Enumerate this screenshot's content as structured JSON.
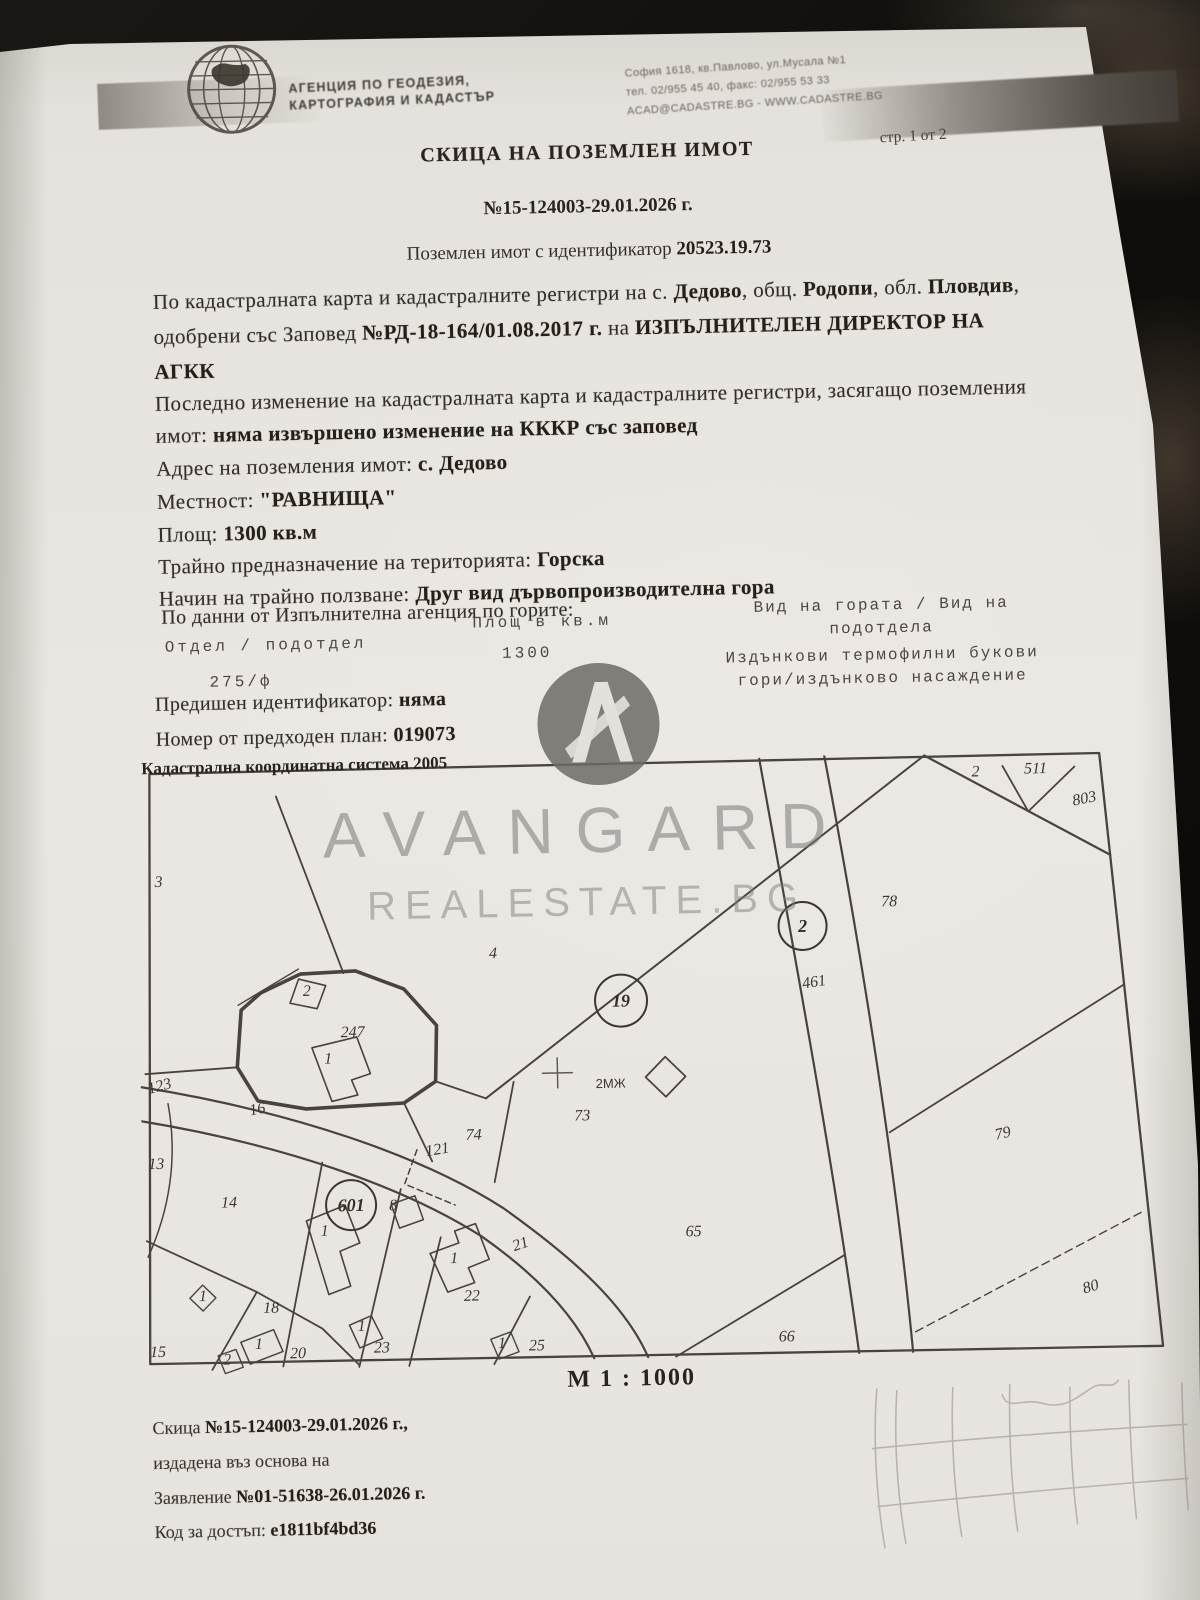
{
  "header": {
    "agency_line1": "АГЕНЦИЯ ПО ГЕОДЕЗИЯ,",
    "agency_line2": "КАРТОГРАФИЯ И КАДАСТЪР",
    "address_line1": "София 1618, кв.Павлово, ул.Мусала №1",
    "address_line2": "тел. 02/955 45 40, факс: 02/955 53 33",
    "address_line3": "ACAD@CADASTRE.BG - WWW.CADASTRE.BG",
    "page_label": "стр. 1 от 2"
  },
  "title": {
    "main": "СКИЦА НА ПОЗЕМЛЕН ИМОТ",
    "number": "№15-124003-29.01.2026 г.",
    "subtitle_prefix": "Поземлен имот с идентификатор ",
    "identifier": "20523.19.73"
  },
  "body": {
    "line1_pre": "По кадастралната карта и кадастралните регистри на с. ",
    "village": "Дедово",
    "line1_mid1": ", общ. ",
    "municipality": "Родопи",
    "line1_mid2": ", обл. ",
    "region": "Пловдив",
    "line1_end": ",",
    "line2_pre": "одобрени със Заповед ",
    "order": "№РД-18-164/01.08.2017 г.",
    "line2_mid": " на ",
    "director_line": "ИЗПЪЛНИТЕЛЕН ДИРЕКТОР НА",
    "agkk": "АГКК",
    "line4": "Последно изменение на кадастралната карта и кадастралните регистри, засягащо поземления",
    "line5_pre": "имот: ",
    "line5_bold": "няма извършено изменение на КККР със заповед",
    "address_label": "Адрес на поземления имот: ",
    "address_value": "с. Дедово",
    "locality_label": "Местност: ",
    "locality_value": "\"РАВНИЩА\"",
    "area_label": "Площ: ",
    "area_value": "1300 кв.м",
    "purpose_label": "Трайно предназначение на територията: ",
    "purpose_value": "Горска",
    "use_label": "Начин на трайно ползване: ",
    "use_value": "Друг вид дървопроизводителна гора",
    "forest_note": "По данни от Изпълнителна агенция по горите:"
  },
  "forest_table": {
    "col1_header": "Отдел / подотдел",
    "col2_header": "Площ в кв.м",
    "col3_header_line1": "Вид на гората / Вид на",
    "col3_header_line2": "подотдела",
    "col1_value": "275/ф",
    "col2_value": "1300",
    "col3_value_line1": "Издънкови термофилни букови",
    "col3_value_line2": "гори/издънково насаждение"
  },
  "details": {
    "prev_id_label": "Предишен идентификатор: ",
    "prev_id_value": "няма",
    "prev_plan_label": "Номер от предходен план: ",
    "prev_plan_value": "019073",
    "coord_system": "Кадастрална координатна система 2005"
  },
  "watermark": {
    "line1": "AVANGARD",
    "line2": "REALESTATE.BG"
  },
  "map": {
    "scale": "М 1 : 1000",
    "subject_identifier": "20523.19.73",
    "circled": [
      {
        "text": "19",
        "x": 482,
        "y": 241,
        "r": 26
      },
      {
        "text": "2",
        "x": 665,
        "y": 170,
        "r": 24
      },
      {
        "text": "601",
        "x": 208,
        "y": 440,
        "r": 25
      }
    ],
    "labels": [
      {
        "text": "3",
        "x": 22,
        "y": 118
      },
      {
        "text": "4",
        "x": 355,
        "y": 196
      },
      {
        "text": "247",
        "x": 213,
        "y": 272
      },
      {
        "text": "2",
        "x": 168,
        "y": 230,
        "size": 13
      },
      {
        "text": "1",
        "x": 188,
        "y": 298,
        "size": 12
      },
      {
        "text": "123",
        "x": 20,
        "y": 322,
        "rot": -14,
        "size": 14
      },
      {
        "text": "16",
        "x": 117,
        "y": 347,
        "rot": -10
      },
      {
        "text": "13",
        "x": 14,
        "y": 400
      },
      {
        "text": "14",
        "x": 86,
        "y": 440
      },
      {
        "text": "15",
        "x": 12,
        "y": 588
      },
      {
        "text": "18",
        "x": 126,
        "y": 546
      },
      {
        "text": "20",
        "x": 152,
        "y": 592
      },
      {
        "text": "23",
        "x": 236,
        "y": 588
      },
      {
        "text": "1",
        "x": 216,
        "y": 566,
        "size": 11
      },
      {
        "text": "25",
        "x": 391,
        "y": 589
      },
      {
        "text": "1",
        "x": 356,
        "y": 586,
        "size": 11
      },
      {
        "text": "22",
        "x": 327,
        "y": 538
      },
      {
        "text": "1",
        "x": 310,
        "y": 500,
        "size": 11
      },
      {
        "text": "21",
        "x": 378,
        "y": 487,
        "rot": -18
      },
      {
        "text": "121",
        "x": 296,
        "y": 391,
        "rot": -8,
        "size": 14
      },
      {
        "text": "74",
        "x": 332,
        "y": 377
      },
      {
        "text": "8",
        "x": 250,
        "y": 446,
        "size": 13
      },
      {
        "text": "1",
        "x": 181,
        "y": 470,
        "size": 12
      },
      {
        "text": "1",
        "x": 58,
        "y": 533,
        "size": 10
      },
      {
        "text": "1",
        "x": 113,
        "y": 582,
        "size": 10
      },
      {
        "text": "2",
        "x": 81,
        "y": 597,
        "size": 10
      },
      {
        "text": "73",
        "x": 441,
        "y": 360
      },
      {
        "text": "2МЖ",
        "x": 470,
        "y": 328,
        "size": 13,
        "sans": true
      },
      {
        "text": "65",
        "x": 550,
        "y": 478
      },
      {
        "text": "66",
        "x": 641,
        "y": 585
      },
      {
        "text": "78",
        "x": 752,
        "y": 152
      },
      {
        "text": "79",
        "x": 862,
        "y": 386,
        "rot": -12
      },
      {
        "text": "80",
        "x": 947,
        "y": 541,
        "rot": -15
      },
      {
        "text": "461",
        "x": 676,
        "y": 231,
        "rot": -8
      },
      {
        "text": "2",
        "x": 841,
        "y": 24,
        "size": 15
      },
      {
        "text": "511",
        "x": 901,
        "y": 22,
        "size": 15
      },
      {
        "text": "803",
        "x": 950,
        "y": 53,
        "rot": -10
      }
    ]
  },
  "footer": {
    "line1_pre": "Скица ",
    "line1_bold": "№15-124003-29.01.2026 г.,",
    "line2": "издадена въз основа на",
    "line3_pre": "Заявление ",
    "line3_bold": "№01-51638-26.01.2026 г.",
    "line4_label": "Код за достъп: ",
    "line4_value": "e1811bf4bd36"
  }
}
